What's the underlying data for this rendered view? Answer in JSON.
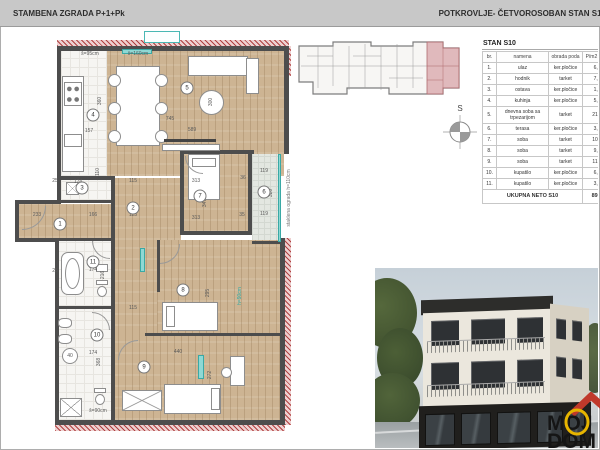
{
  "header": {
    "left_title": "STAMBENA ZGRADA P+1+Pk",
    "right_title": "POTKROVLJE- ČETVOROSOBAN STAN S10"
  },
  "compass": {
    "label": "S"
  },
  "logo": {
    "line1": "MOJ",
    "line2": "DOM",
    "accent_yellow": "#e6b400",
    "accent_red": "#c0392b"
  },
  "table": {
    "title": "STAN S10",
    "columns": [
      "br.",
      "namena",
      "obrada poda",
      "P/m2 100%"
    ],
    "rows": [
      [
        "1.",
        "ulaz",
        "ker.pločice",
        "6,92"
      ],
      [
        "2.",
        "hodnik",
        "tarket",
        "7,60"
      ],
      [
        "3.",
        "ostava",
        "ker.pločice",
        "1,91"
      ],
      [
        "4.",
        "kuhinja",
        "ker.pločice",
        "5,84"
      ],
      [
        "5.",
        "dnevna soba sa trpezarijom",
        "tarket",
        "21,16"
      ],
      [
        "6.",
        "terasa",
        "ker.pločice",
        "3,74"
      ],
      [
        "7.",
        "soba",
        "tarket",
        "10,77"
      ],
      [
        "8.",
        "soba",
        "tarket",
        "9,23"
      ],
      [
        "9.",
        "soba",
        "tarket",
        "11,96"
      ],
      [
        "10.",
        "kupatilo",
        "ker.pločice",
        "6,89"
      ],
      [
        "11.",
        "kupatilo",
        "ker.pločice",
        "3,65"
      ]
    ],
    "footer_label": "UKUPNA NETO S10",
    "footer_value": "89,20"
  },
  "plan": {
    "room_numbers": [
      {
        "n": "1",
        "x": 48,
        "y": 194
      },
      {
        "n": "2",
        "x": 121,
        "y": 178
      },
      {
        "n": "3",
        "x": 70,
        "y": 158
      },
      {
        "n": "4",
        "x": 81,
        "y": 85
      },
      {
        "n": "5",
        "x": 175,
        "y": 58
      },
      {
        "n": "6",
        "x": 252,
        "y": 162
      },
      {
        "n": "7",
        "x": 188,
        "y": 166
      },
      {
        "n": "8",
        "x": 171,
        "y": 260
      },
      {
        "n": "9",
        "x": 132,
        "y": 337
      },
      {
        "n": "10",
        "x": 85,
        "y": 305
      },
      {
        "n": "11",
        "x": 81,
        "y": 232
      }
    ],
    "dimensions": [
      {
        "t": "š=95cm",
        "x": 78,
        "y": 24
      },
      {
        "t": "š=160cm",
        "x": 126,
        "y": 24
      },
      {
        "t": "360",
        "x": 88,
        "y": 71,
        "v": 1
      },
      {
        "t": "300",
        "x": 199,
        "y": 72,
        "v": 1
      },
      {
        "t": "745",
        "x": 158,
        "y": 89
      },
      {
        "t": "589",
        "x": 180,
        "y": 100
      },
      {
        "t": "157",
        "x": 77,
        "y": 101
      },
      {
        "t": "36",
        "x": 231,
        "y": 148
      },
      {
        "t": "313",
        "x": 184,
        "y": 151
      },
      {
        "t": "115",
        "x": 121,
        "y": 151
      },
      {
        "t": "25",
        "x": 43,
        "y": 151
      },
      {
        "t": "110",
        "x": 86,
        "y": 142,
        "v": 1
      },
      {
        "t": "174",
        "x": 66,
        "y": 152
      },
      {
        "t": "119",
        "x": 252,
        "y": 141
      },
      {
        "t": "320",
        "x": 259,
        "y": 163,
        "v": 1
      },
      {
        "t": "347",
        "x": 193,
        "y": 173,
        "v": 1
      },
      {
        "t": "233",
        "x": 25,
        "y": 185
      },
      {
        "t": "166",
        "x": 81,
        "y": 185
      },
      {
        "t": "115",
        "x": 121,
        "y": 185
      },
      {
        "t": "313",
        "x": 184,
        "y": 188
      },
      {
        "t": "119",
        "x": 252,
        "y": 184
      },
      {
        "t": "35",
        "x": 230,
        "y": 185
      },
      {
        "t": "174",
        "x": 81,
        "y": 240
      },
      {
        "t": "216",
        "x": 91,
        "y": 245,
        "v": 1
      },
      {
        "t": "25",
        "x": 43,
        "y": 241
      },
      {
        "t": "295",
        "x": 196,
        "y": 263,
        "v": 1
      },
      {
        "t": "115",
        "x": 121,
        "y": 278
      },
      {
        "t": "40",
        "x": 58,
        "y": 326
      },
      {
        "t": "174",
        "x": 81,
        "y": 323
      },
      {
        "t": "368",
        "x": 87,
        "y": 332,
        "v": 1
      },
      {
        "t": "440",
        "x": 166,
        "y": 322
      },
      {
        "t": "272",
        "x": 198,
        "y": 345,
        "v": 1
      },
      {
        "t": "š=90cm",
        "x": 86,
        "y": 381
      }
    ],
    "notes": [
      {
        "t": "staklena ograda h=110cm",
        "x": 277,
        "y": 168,
        "v": 1,
        "c": "#777777"
      },
      {
        "t": "h=90cm",
        "x": 228,
        "y": 266,
        "v": 1,
        "c": "#2aa9a5"
      }
    ]
  }
}
